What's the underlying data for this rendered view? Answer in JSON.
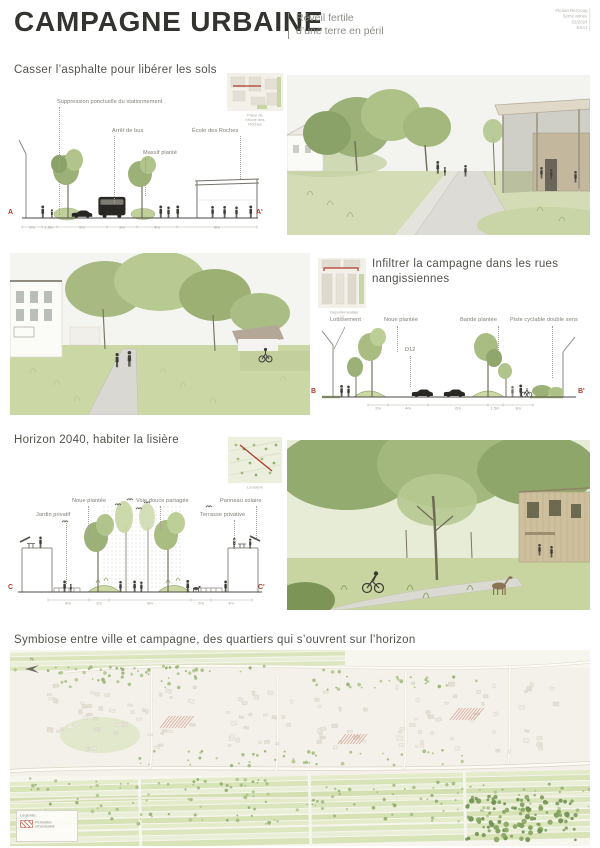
{
  "colors": {
    "accent_red": "#b03a2e",
    "green_light": "#bccf97",
    "green_mid": "#9cb177",
    "green_dark": "#8fa76b",
    "ink": "#3f3d38",
    "muted_text": "#8c8c8c"
  },
  "header": {
    "title": "CAMPAGNE URBAINE",
    "subtitle": [
      "Réveil fertile",
      "d’une terre en péril"
    ],
    "credits": [
      "Florian Rezzoug",
      "5ème année",
      "03/2024",
      "ESAJ"
    ]
  },
  "sections": {
    "s1": {
      "title": "Casser l’asphalte pour libérer les sols",
      "map_caption": "Place de l’école des Roches",
      "labels": {
        "suppression": "Suppression ponctuelle du stationnement",
        "arret_bus": "Arrêt de bus",
        "ecole": "École des Roches",
        "massif": "Massif planté"
      },
      "marker_left": "A",
      "marker_right": "A'",
      "dims": [
        "2m",
        "1.5m",
        "5m",
        "3m",
        "4m",
        "8m"
      ]
    },
    "s2": {
      "title": "Infiltrer la campagne dans les rues nangissiennes",
      "map_caption": "Départementale 12",
      "labels": {
        "lotissement": "Lotissement",
        "noue": "Noue plantée",
        "bande": "Bande plantée",
        "piste": "Piste cyclable double sens",
        "road": "D12"
      },
      "marker_left": "B",
      "marker_right": "B'",
      "dims": [
        "2m",
        "4m",
        "6m",
        "1.5m",
        "3m"
      ]
    },
    "s3": {
      "title": "Horizon 2040, habiter la lisière",
      "map_caption": "La lisière",
      "labels": {
        "noue": "Noue plantée",
        "voie": "Voie douce partagée",
        "panneau": "Panneau solaire",
        "jardin": "Jardin privatif",
        "terrasse": "Terrasse privative"
      },
      "marker_left": "C",
      "marker_right": "C'",
      "dims": [
        "4m",
        "2m",
        "8m",
        "2m",
        "4m"
      ]
    },
    "s4": {
      "title": "Symbiose entre ville et campagne, des quartiers qui s’ouvrent sur l’horizon",
      "north_label": "N",
      "legend": {
        "title": "Légende:",
        "item": "Périmètre urbanisable"
      }
    }
  },
  "icons": {
    "north-arrow-icon": "triangle-arrow",
    "tree-icon": "green-ellipses",
    "person-icon": "silhouette",
    "bus-icon": "black-rounded-rect",
    "car-icon": "black-sedan",
    "bird-icon": "double-arc"
  }
}
